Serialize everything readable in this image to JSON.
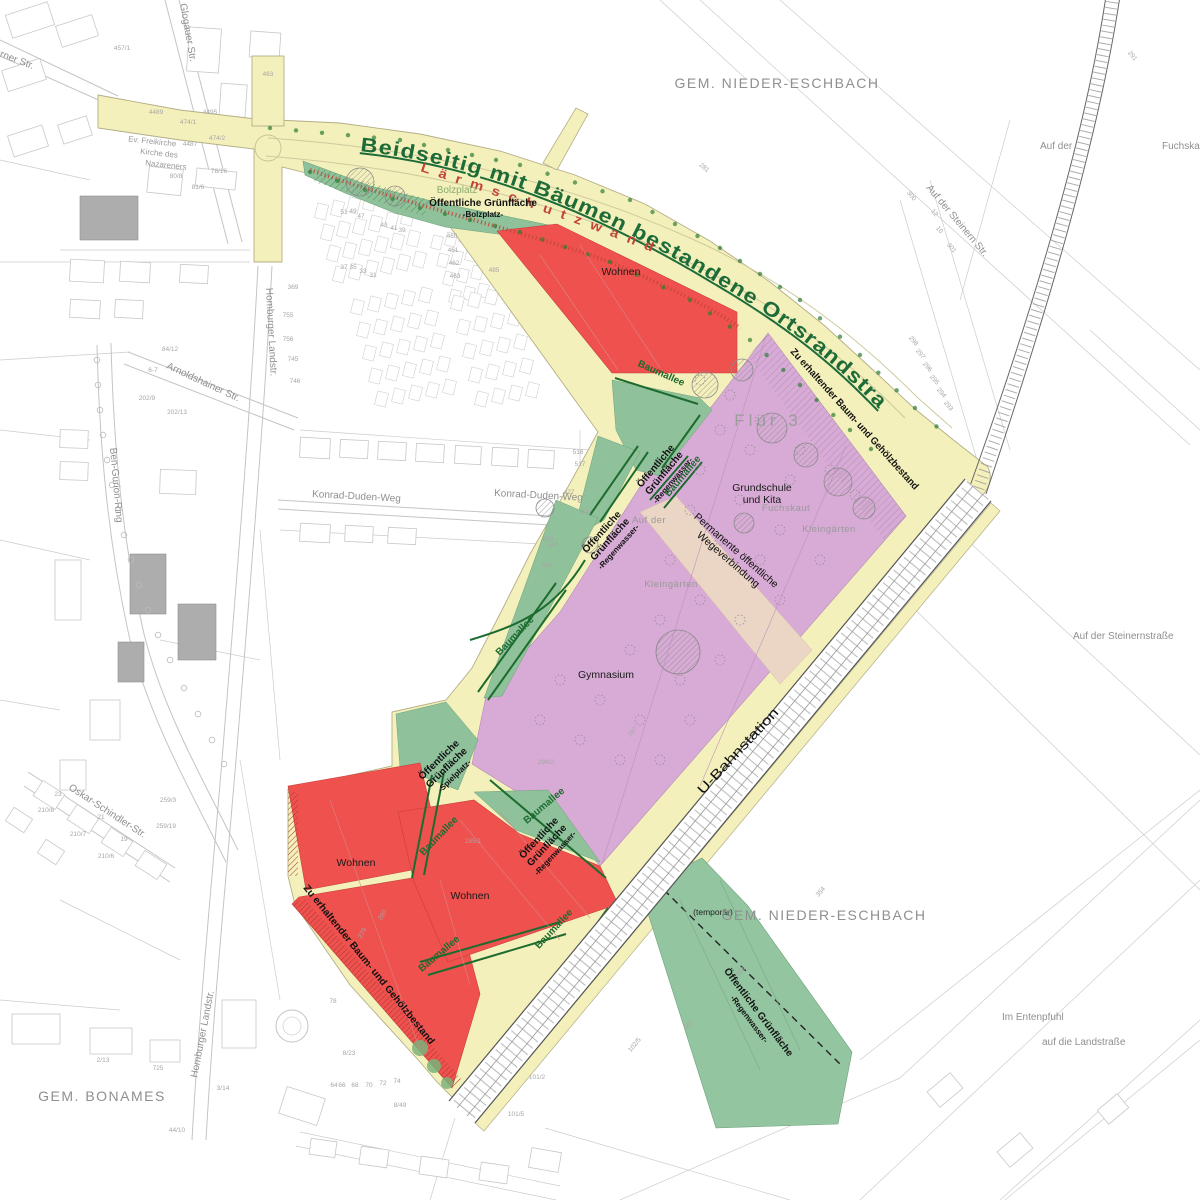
{
  "plan": {
    "arc_road_label": "Beidseitig mit Bäumen bestandene Ortsrandstraße",
    "noise_wall_label": "Lärmschutzwand",
    "ubahn_label": "U-Bahnstation",
    "flur_label": "Flur 3",
    "temp_label": "(temporär)",
    "bolzplatz_ghost": "Bolzplatz",
    "wohnen_labels": [
      "Wohnen",
      "Wohnen",
      "Wohnen"
    ],
    "municipalities": [
      {
        "text": "GEM. NIEDER-ESCHBACH",
        "x": 777,
        "y": 84
      },
      {
        "text": "GEM. NIEDER-ESCHBACH",
        "x": 824,
        "y": 916
      },
      {
        "text": "GEM. BONAMES",
        "x": 102,
        "y": 1098
      }
    ],
    "preserve_labels": [
      {
        "text": "Zu erhaltender Baum- und Gehölzbestand",
        "x": 790,
        "y": 352,
        "r": 48,
        "len": 186
      },
      {
        "text": "Zu erhaltender Baum- und Gehölzbestand",
        "x": 303,
        "y": 888,
        "r": 51,
        "len": 202
      }
    ],
    "facility_labels": [
      {
        "lines": [
          "Grundschule",
          "und Kita"
        ],
        "x": 762,
        "y": 491
      },
      {
        "lines": [
          "Gymnasium"
        ],
        "x": 606,
        "y": 678
      }
    ],
    "green_labels": [
      {
        "lines": [
          "Öffentliche Grünfläche",
          "-Bolzplatz-"
        ],
        "x": 483,
        "y": 206,
        "r": 0
      },
      {
        "lines": [
          "Öffentliche",
          "Grünfläche",
          "-Regenwasser-"
        ],
        "x": 658,
        "y": 468,
        "r": -50
      },
      {
        "lines": [
          "Öffentliche",
          "Grünfläche",
          "-Regenwasser-"
        ],
        "x": 604,
        "y": 534,
        "r": -48
      },
      {
        "lines": [
          "Öffentliche",
          "Grünfläche",
          "-Spielplatz-"
        ],
        "x": 441,
        "y": 762,
        "r": -44
      },
      {
        "lines": [
          "Öffentliche",
          "Grünfläche",
          "-Regenwasser-"
        ],
        "x": 541,
        "y": 840,
        "r": -47
      },
      {
        "lines": [
          "Öffentliche Grünfläche",
          "-Regenwasser-"
        ],
        "x": 756,
        "y": 1014,
        "r": 53
      }
    ],
    "path_label": {
      "lines": [
        "Permanente öffentliche",
        "Wegeverbindung"
      ],
      "x": 734,
      "y": 553,
      "r": 41
    },
    "baumallee_text": "Baumallee",
    "baumallee_labels": [
      {
        "x": 660,
        "y": 376,
        "r": 24
      },
      {
        "x": 685,
        "y": 478,
        "r": -50
      },
      {
        "x": 517,
        "y": 638,
        "r": -46
      },
      {
        "x": 441,
        "y": 838,
        "r": -46
      },
      {
        "x": 546,
        "y": 808,
        "r": -40
      },
      {
        "x": 441,
        "y": 956,
        "r": -40
      },
      {
        "x": 556,
        "y": 931,
        "r": -47
      }
    ],
    "streets": [
      {
        "t": "Berner Str.",
        "x": -12,
        "y": 52,
        "r": 21
      },
      {
        "t": "Glogauer Str.",
        "x": 180,
        "y": 4,
        "r": 80
      },
      {
        "t": "Homburger Landstr.",
        "x": 266,
        "y": 288,
        "r": 87
      },
      {
        "t": "Homburger Landstr.",
        "x": 197,
        "y": 1078,
        "r": -79
      },
      {
        "t": "Ben-Gurion-Ring",
        "x": 110,
        "y": 448,
        "r": 85
      },
      {
        "t": "Oskar-Schindler-Str.",
        "x": 68,
        "y": 789,
        "r": 33
      },
      {
        "t": "Arnoldshainer Str.",
        "x": 166,
        "y": 368,
        "r": 25
      },
      {
        "t": "Konrad-Duden-Weg",
        "x": 312,
        "y": 497,
        "r": 3
      },
      {
        "t": "Konrad-Duden-Weg",
        "x": 494,
        "y": 496,
        "r": 3
      },
      {
        "t": "Auf der Steinern Str.",
        "x": 926,
        "y": 188,
        "r": 50
      },
      {
        "t": "Auf der Steinernstraße",
        "x": 1073,
        "y": 639,
        "r": 0
      },
      {
        "t": "Auf der",
        "x": 1040,
        "y": 149,
        "r": 0
      },
      {
        "t": "Fuchskaut",
        "x": 1162,
        "y": 149,
        "r": 0
      },
      {
        "t": "Im Entenpfuhl",
        "x": 1002,
        "y": 1020,
        "r": 0
      },
      {
        "t": "auf die Landstraße",
        "x": 1042,
        "y": 1045,
        "r": 0
      }
    ],
    "area_names": [
      {
        "t": "Fuchskaut",
        "x": 786,
        "y": 511
      },
      {
        "t": "Kleingärten",
        "x": 829,
        "y": 532
      },
      {
        "t": "Kleingärten",
        "x": 671,
        "y": 587
      },
      {
        "t": "Auf der",
        "x": 649,
        "y": 523
      }
    ],
    "church_label": {
      "lines": [
        "Ev. Freikirche",
        "Kirche des",
        "Nazareners"
      ],
      "x": 152,
      "y": 144
    },
    "parcel_numbers": [
      {
        "t": "457/1",
        "x": 122,
        "y": 50
      },
      {
        "t": "4495",
        "x": 210,
        "y": 114
      },
      {
        "t": "474/1",
        "x": 188,
        "y": 124
      },
      {
        "t": "474/2",
        "x": 217,
        "y": 140
      },
      {
        "t": "4487",
        "x": 190,
        "y": 146
      },
      {
        "t": "4489",
        "x": 156,
        "y": 114
      },
      {
        "t": "80/8",
        "x": 176,
        "y": 178
      },
      {
        "t": "78/16",
        "x": 219,
        "y": 173
      },
      {
        "t": "81/6",
        "x": 198,
        "y": 189
      },
      {
        "t": "463",
        "x": 268,
        "y": 76
      },
      {
        "t": "369",
        "x": 293,
        "y": 289
      },
      {
        "t": "755",
        "x": 288,
        "y": 317
      },
      {
        "t": "756",
        "x": 288,
        "y": 341
      },
      {
        "t": "745",
        "x": 293,
        "y": 361
      },
      {
        "t": "746",
        "x": 295,
        "y": 383
      },
      {
        "t": "84/12",
        "x": 170,
        "y": 351
      },
      {
        "t": "6-7",
        "x": 153,
        "y": 372
      },
      {
        "t": "202/9",
        "x": 147,
        "y": 400
      },
      {
        "t": "202/13",
        "x": 177,
        "y": 414
      },
      {
        "t": "51",
        "x": 344,
        "y": 214
      },
      {
        "t": "49",
        "x": 353,
        "y": 213
      },
      {
        "t": "47",
        "x": 361,
        "y": 218
      },
      {
        "t": "43",
        "x": 384,
        "y": 227
      },
      {
        "t": "41",
        "x": 394,
        "y": 230
      },
      {
        "t": "39",
        "x": 402,
        "y": 232
      },
      {
        "t": "37",
        "x": 344,
        "y": 269
      },
      {
        "t": "35",
        "x": 353,
        "y": 269
      },
      {
        "t": "33",
        "x": 363,
        "y": 273
      },
      {
        "t": "31",
        "x": 373,
        "y": 277
      },
      {
        "t": "460",
        "x": 452,
        "y": 238
      },
      {
        "t": "461",
        "x": 453,
        "y": 252
      },
      {
        "t": "462",
        "x": 454,
        "y": 265
      },
      {
        "t": "463",
        "x": 455,
        "y": 278
      },
      {
        "t": "485",
        "x": 494,
        "y": 272
      },
      {
        "t": "427",
        "x": 569,
        "y": 494
      },
      {
        "t": "442",
        "x": 586,
        "y": 514
      },
      {
        "t": "516",
        "x": 578,
        "y": 454
      },
      {
        "t": "517",
        "x": 580,
        "y": 466
      },
      {
        "t": "439",
        "x": 548,
        "y": 541
      },
      {
        "t": "440",
        "x": 553,
        "y": 547
      },
      {
        "t": "454",
        "x": 547,
        "y": 567
      },
      {
        "t": "296/2",
        "x": 546,
        "y": 764
      },
      {
        "t": "297",
        "x": 634,
        "y": 733,
        "r": -50
      },
      {
        "t": "285/1",
        "x": 473,
        "y": 843
      },
      {
        "t": "280",
        "x": 384,
        "y": 916,
        "r": -60
      },
      {
        "t": "279",
        "x": 364,
        "y": 934,
        "r": -60
      },
      {
        "t": "354",
        "x": 822,
        "y": 893,
        "r": -50
      },
      {
        "t": "353",
        "x": 742,
        "y": 973,
        "r": -50
      },
      {
        "t": "357",
        "x": 690,
        "y": 1026,
        "r": -50
      },
      {
        "t": "102/5",
        "x": 636,
        "y": 1046,
        "r": -50
      },
      {
        "t": "300",
        "x": 910,
        "y": 197,
        "r": 50
      },
      {
        "t": "301",
        "x": 950,
        "y": 249,
        "r": 50
      },
      {
        "t": "12",
        "x": 933,
        "y": 214,
        "r": 50
      },
      {
        "t": "10",
        "x": 938,
        "y": 231,
        "r": 50
      },
      {
        "t": "298",
        "x": 912,
        "y": 342,
        "r": 50
      },
      {
        "t": "297",
        "x": 919,
        "y": 355,
        "r": 50
      },
      {
        "t": "296",
        "x": 926,
        "y": 368,
        "r": 50
      },
      {
        "t": "295",
        "x": 933,
        "y": 381,
        "r": 50
      },
      {
        "t": "294",
        "x": 940,
        "y": 394,
        "r": 50
      },
      {
        "t": "293",
        "x": 947,
        "y": 407,
        "r": 50
      },
      {
        "t": "291",
        "x": 1131,
        "y": 57,
        "r": 50
      },
      {
        "t": "281",
        "x": 703,
        "y": 169,
        "r": 40
      },
      {
        "t": "23",
        "x": 58,
        "y": 796
      },
      {
        "t": "21",
        "x": 101,
        "y": 819
      },
      {
        "t": "19",
        "x": 124,
        "y": 841
      },
      {
        "t": "210/8",
        "x": 46,
        "y": 812
      },
      {
        "t": "210/7",
        "x": 78,
        "y": 836
      },
      {
        "t": "210/6",
        "x": 106,
        "y": 858
      },
      {
        "t": "259/3",
        "x": 168,
        "y": 802
      },
      {
        "t": "259/19",
        "x": 166,
        "y": 828
      },
      {
        "t": "2/13",
        "x": 103,
        "y": 1062
      },
      {
        "t": "3/14",
        "x": 223,
        "y": 1090
      },
      {
        "t": "44/10",
        "x": 177,
        "y": 1132
      },
      {
        "t": "725",
        "x": 158,
        "y": 1070
      },
      {
        "t": "78",
        "x": 333,
        "y": 1003
      },
      {
        "t": "8/23",
        "x": 349,
        "y": 1055
      },
      {
        "t": "64",
        "x": 334,
        "y": 1087
      },
      {
        "t": "66",
        "x": 342,
        "y": 1087
      },
      {
        "t": "68",
        "x": 355,
        "y": 1087
      },
      {
        "t": "70",
        "x": 369,
        "y": 1087
      },
      {
        "t": "72",
        "x": 383,
        "y": 1085
      },
      {
        "t": "74",
        "x": 397,
        "y": 1083
      },
      {
        "t": "8/49",
        "x": 400,
        "y": 1107
      },
      {
        "t": "101/2",
        "x": 537,
        "y": 1079
      },
      {
        "t": "101/5",
        "x": 516,
        "y": 1116
      }
    ],
    "colors": {
      "plan_area": "#f4f0bb",
      "residential": "#ef514e",
      "school": "#d7abd5",
      "green_space": "#8fc19b",
      "green_band": "#93c5a0",
      "path_band": "#ebd6c5",
      "green_dark": "#1d6b2f",
      "road_text_green": "#1c6b38",
      "wall_red": "#c2453a",
      "cadastre_line": "#cccccc",
      "label_gray": "#8f8f8f"
    }
  }
}
